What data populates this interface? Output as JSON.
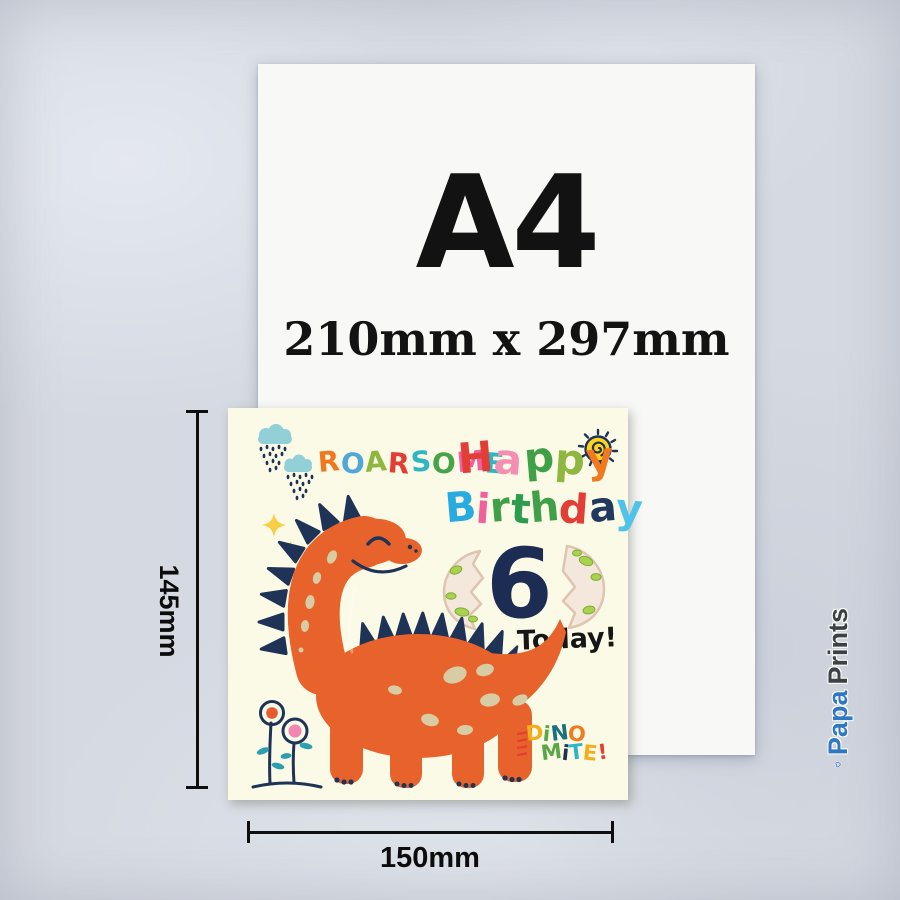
{
  "a4_sheet": {
    "title": "A4",
    "size_label": "210mm x 297mm"
  },
  "greeting_card": {
    "word_roarsome": [
      {
        "ch": "R",
        "color": "#F0791F"
      },
      {
        "ch": "O",
        "color": "#4FA8D8"
      },
      {
        "ch": "A",
        "color": "#8DB73F"
      },
      {
        "ch": "R",
        "color": "#E23E36"
      },
      {
        "ch": "S",
        "color": "#2FB6C2"
      },
      {
        "ch": "O",
        "color": "#45A348"
      },
      {
        "ch": "M",
        "color": "#F0609E"
      },
      {
        "ch": "E",
        "color": "#2FB6C2"
      }
    ],
    "word_happy": [
      {
        "ch": "H",
        "color": "#E23E36"
      },
      {
        "ch": "a",
        "color": "#F48FB3"
      },
      {
        "ch": "p",
        "color": "#3FA047"
      },
      {
        "ch": "p",
        "color": "#8DB73F"
      },
      {
        "ch": "y",
        "color": "#F0791F"
      }
    ],
    "word_birthday": [
      {
        "ch": "B",
        "color": "#29ABE2"
      },
      {
        "ch": "i",
        "color": "#F0609E"
      },
      {
        "ch": "r",
        "color": "#3FA047"
      },
      {
        "ch": "t",
        "color": "#2E9C4F"
      },
      {
        "ch": "h",
        "color": "#3FA047"
      },
      {
        "ch": "d",
        "color": "#E23E36"
      },
      {
        "ch": "a",
        "color": "#22395F"
      },
      {
        "ch": "y",
        "color": "#4FC3E8"
      }
    ],
    "age_number": "6",
    "today_label": "Today!",
    "logo_line1": [
      {
        "ch": "D",
        "color": "#F2AE1C"
      },
      {
        "ch": "i",
        "color": "#59A845"
      },
      {
        "ch": "N",
        "color": "#17727E"
      },
      {
        "ch": "O",
        "color": "#F07C22"
      }
    ],
    "logo_line2": [
      {
        "ch": "M",
        "color": "#59A845"
      },
      {
        "ch": "i",
        "color": "#1F3054"
      },
      {
        "ch": "T",
        "color": "#2FB6C2"
      },
      {
        "ch": "E",
        "color": "#F2AE1C"
      },
      {
        "ch": "!",
        "color": "#E23E36"
      }
    ]
  },
  "dimension_labels": {
    "card_height": "145mm",
    "card_width": "150mm"
  },
  "brand": {
    "name_part1": "Papa",
    "name_part2": "Prints",
    "part1_color": "#2E78C6",
    "part2_color": "#3C4148"
  },
  "art_colors": {
    "card_bg": "#FBFAE6",
    "dino_body": "#E8632C",
    "spikes_navy": "#1E3356",
    "spots": "#D8CCA4",
    "egg_shell": "#F4E8DC",
    "egg_outline": "#E0C4B2",
    "egg_spot": "#A9D24D",
    "egg_spot_edge": "#7FA93C",
    "cloud": "#92CFD7",
    "sun_yellow": "#FFD21E",
    "leaf_teal": "#2B9FAE",
    "sparkle_yellow": "#F8CE46",
    "flower_orange": "#E85A30",
    "flower_pink": "#F285B2"
  }
}
